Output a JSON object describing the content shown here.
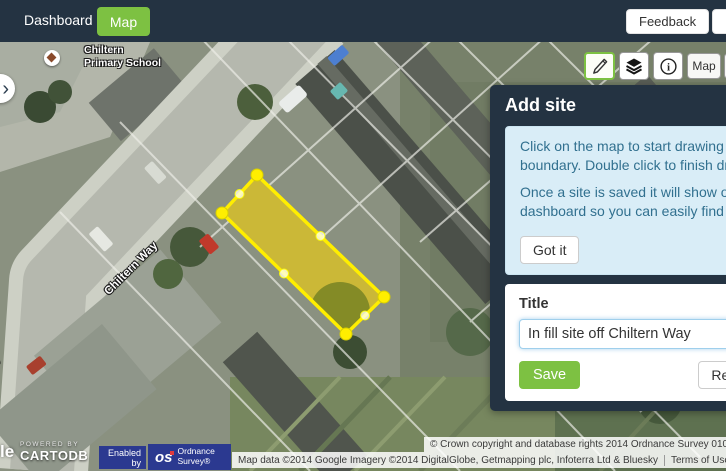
{
  "navbar": {
    "dashboard": "Dashboard",
    "map": "Map",
    "feedback": "Feedback"
  },
  "map_toolbar": {
    "map_type_map": "Map",
    "map_type_satellite_partial": "S"
  },
  "panel": {
    "title": "Add site",
    "info_para1": "Click on the map to start drawing a site boundary. Double click to finish drawing.",
    "info_para2": "Once a site is saved it will show on your dashboard so you can easily find it again.",
    "got_it": "Got it",
    "form": {
      "title_label": "Title",
      "title_value": "In fill site off Chiltern Way",
      "save": "Save",
      "reset": "Reset"
    }
  },
  "map": {
    "school_label": "Chiltern\nPrimary School",
    "street_label": "Chiltern Way",
    "street_label_partial": "Chiltern Way",
    "site_polygon": {
      "points": [
        [
          257,
          133
        ],
        [
          222,
          171
        ],
        [
          346,
          292
        ],
        [
          384,
          255
        ]
      ],
      "stroke": "#ffee00",
      "fill": "rgba(255,255,0,0.30)"
    }
  },
  "attribution": {
    "google_partial": "le",
    "powered_by": "POWERED BY",
    "cartodb": "CARTODB",
    "enabled_by": "Enabled by",
    "os_abbr": "os",
    "os_name": "Ordnance Survey®",
    "crown": "© Crown copyright and database rights 2014 Ordnance Survey 010",
    "map_data": "Map data ©2014 Google Imagery ©2014 DigitalGlobe, Getmapping plc, Infoterra Ltd & Bluesky",
    "terms": "Terms of Use",
    "report": "Report a map error"
  },
  "colors": {
    "accent_green": "#7dc142",
    "navy": "#243342",
    "info_bg": "#d9edf7",
    "info_text": "#31708f"
  }
}
